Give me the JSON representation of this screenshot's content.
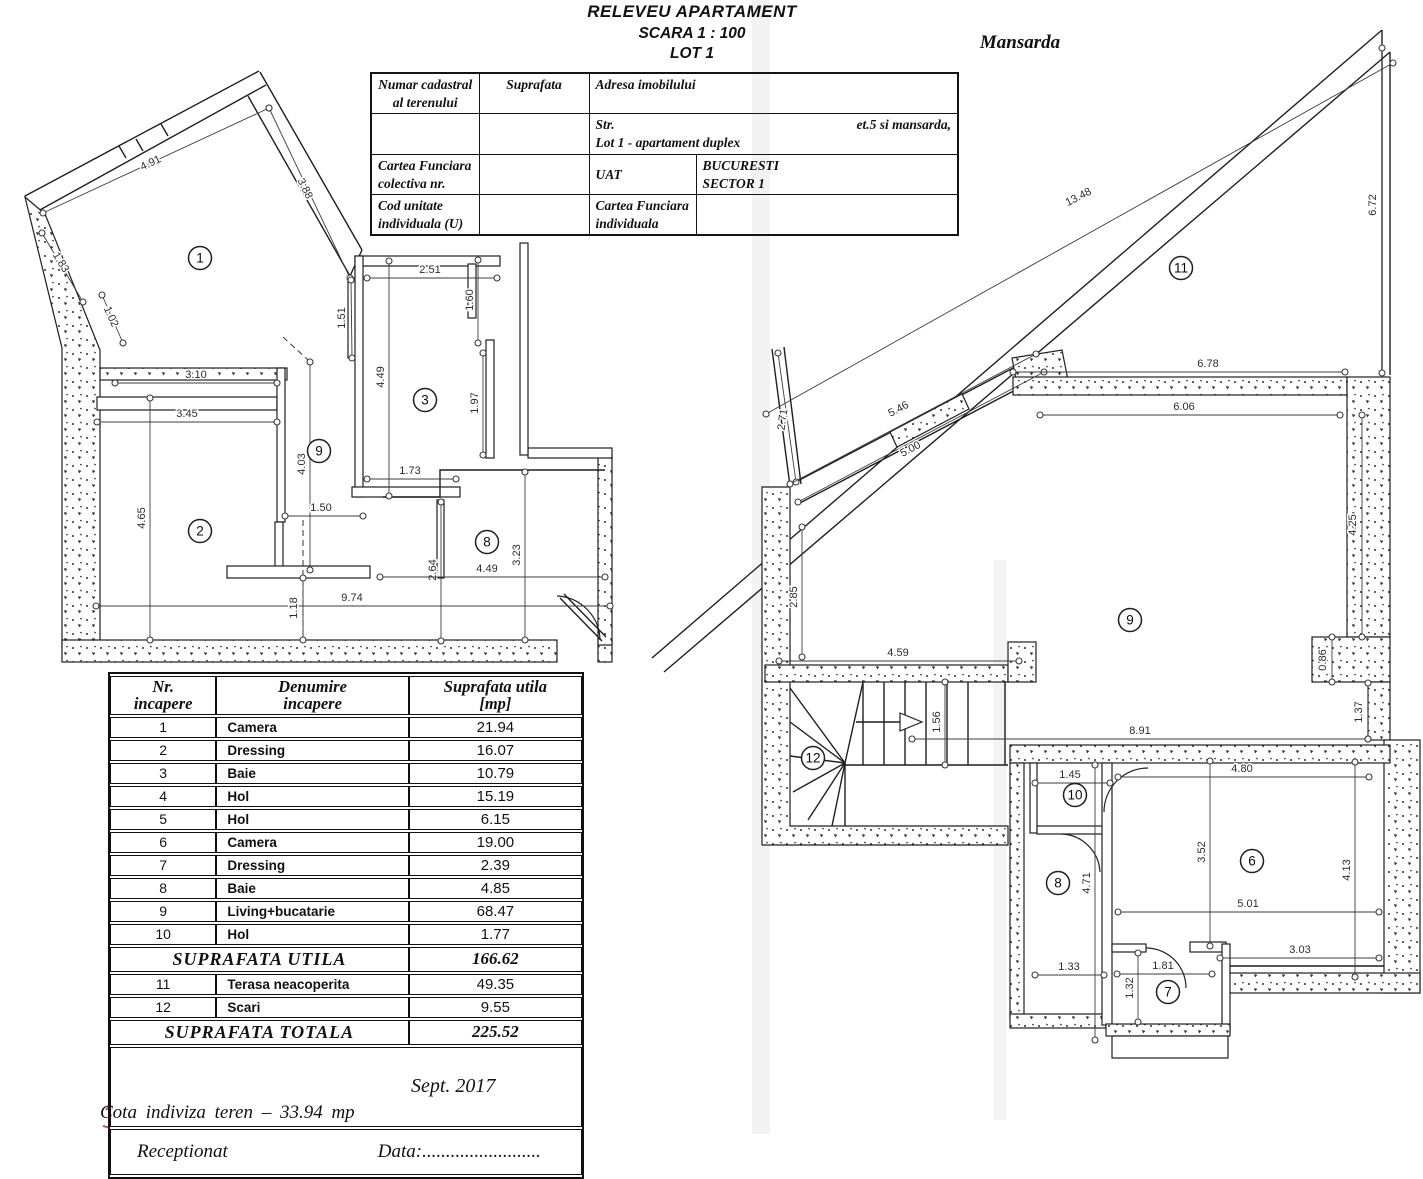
{
  "title": {
    "line1": "RELEVEU APARTAMENT",
    "line2": "SCARA 1 : 100",
    "line3": "LOT 1"
  },
  "plan_labels": {
    "right": "Mansarda"
  },
  "cadastral_table": {
    "r1c1": "Numar cadastral al terenului",
    "r1c2": "Suprafata",
    "r1c3": "Adresa imobilului",
    "r2_str": "Str.",
    "r2_et": "et.5 si mansarda,",
    "r2_lot": "Lot 1 - apartament duplex",
    "r3c1a": "Cartea Funciara",
    "r3c1b": "colectiva nr.",
    "r3c3": "UAT",
    "r3c4a": "BUCURESTI",
    "r3c4b": "SECTOR 1",
    "r4c1a": "Cod unitate",
    "r4c1b": "individuala (U)",
    "r4c3a": "Cartea Funciara",
    "r4c3b": "individuala"
  },
  "room_table": {
    "header": {
      "col1a": "Nr.",
      "col1b": "incapere",
      "col2a": "Denumire",
      "col2b": "incapere",
      "col3a": "Suprafata utila",
      "col3b": "[mp]"
    },
    "rows": [
      {
        "nr": "1",
        "name": "Camera",
        "area": "21.94"
      },
      {
        "nr": "2",
        "name": "Dressing",
        "area": "16.07"
      },
      {
        "nr": "3",
        "name": "Baie",
        "area": "10.79"
      },
      {
        "nr": "4",
        "name": "Hol",
        "area": "15.19"
      },
      {
        "nr": "5",
        "name": "Hol",
        "area": "6.15"
      },
      {
        "nr": "6",
        "name": "Camera",
        "area": "19.00"
      },
      {
        "nr": "7",
        "name": "Dressing",
        "area": "2.39"
      },
      {
        "nr": "8",
        "name": "Baie",
        "area": "4.85"
      },
      {
        "nr": "9",
        "name": "Living+bucatarie",
        "area": "68.47"
      },
      {
        "nr": "10",
        "name": "Hol",
        "area": "1.77"
      }
    ],
    "subtotal_label": "SUPRAFATA  UTILA",
    "subtotal_value": "166.62",
    "rows2": [
      {
        "nr": "11",
        "name": "Terasa neacoperita",
        "area": "49.35"
      },
      {
        "nr": "12",
        "name": "Scari",
        "area": "9.55"
      }
    ],
    "total_label": "SUPRAFATA  TOTALA",
    "total_value": "225.52",
    "date": "Sept.  2017",
    "receptionat": "Receptionat",
    "data_label": "Data:.........................",
    "cota_line": "Cota indiviza teren   –   33.94  mp"
  },
  "floorplan_left": {
    "rooms": [
      {
        "n": "1",
        "x": 200,
        "y": 258
      },
      {
        "n": "2",
        "x": 200,
        "y": 531
      },
      {
        "n": "3",
        "x": 425,
        "y": 400
      },
      {
        "n": "9",
        "x": 319,
        "y": 451
      },
      {
        "n": "8",
        "x": 487,
        "y": 542
      }
    ],
    "dims": [
      {
        "t": "4.91",
        "x1": 43,
        "y1": 213,
        "x2": 269,
        "y2": 108,
        "tx": 152,
        "ty": 166,
        "r": -25
      },
      {
        "t": "3.88",
        "x1": 269,
        "y1": 108,
        "x2": 350,
        "y2": 278,
        "tx": 302,
        "ty": 190,
        "r": 64
      },
      {
        "t": "1.83",
        "x1": 42,
        "y1": 233,
        "x2": 83,
        "y2": 302,
        "tx": 58,
        "ty": 264,
        "r": 59
      },
      {
        "t": "1.02",
        "x1": 102,
        "y1": 295,
        "x2": 123,
        "y2": 343,
        "tx": 108,
        "ty": 318,
        "r": 66
      },
      {
        "t": "3.10",
        "x1": 115,
        "y1": 383,
        "x2": 277,
        "y2": 383,
        "tx": 196,
        "ty": 378,
        "r": 0
      },
      {
        "t": "1.51",
        "x1": 351,
        "y1": 280,
        "x2": 352,
        "y2": 358,
        "tx": 345,
        "ty": 318,
        "r": -90
      },
      {
        "t": "3.45",
        "x1": 97,
        "y1": 422,
        "x2": 277,
        "y2": 422,
        "tx": 187,
        "ty": 417,
        "r": 0
      },
      {
        "t": "4.65",
        "x1": 150,
        "y1": 398,
        "x2": 150,
        "y2": 640,
        "tx": 145,
        "ty": 518,
        "r": -90
      },
      {
        "t": "2.51",
        "x1": 367,
        "y1": 278,
        "x2": 497,
        "y2": 278,
        "tx": 430,
        "ty": 273,
        "r": 0
      },
      {
        "t": "1.60",
        "x1": 478,
        "y1": 260,
        "x2": 478,
        "y2": 343,
        "tx": 473,
        "ty": 300,
        "r": -90
      },
      {
        "t": "4.49",
        "x1": 389,
        "y1": 261,
        "x2": 389,
        "y2": 496,
        "tx": 384,
        "ty": 377,
        "r": -90
      },
      {
        "t": "1.97",
        "x1": 483,
        "y1": 353,
        "x2": 483,
        "y2": 455,
        "tx": 478,
        "ty": 403,
        "r": -90
      },
      {
        "t": "4.03",
        "x1": 310,
        "y1": 362,
        "x2": 310,
        "y2": 570,
        "tx": 305,
        "ty": 464,
        "r": -90
      },
      {
        "t": "1.73",
        "x1": 367,
        "y1": 479,
        "x2": 456,
        "y2": 479,
        "tx": 410,
        "ty": 474,
        "r": 0
      },
      {
        "t": "1.50",
        "x1": 285,
        "y1": 516,
        "x2": 363,
        "y2": 516,
        "tx": 321,
        "ty": 511,
        "r": 0
      },
      {
        "t": "9.74",
        "x1": 96,
        "y1": 606,
        "x2": 610,
        "y2": 606,
        "tx": 352,
        "ty": 601,
        "r": 0
      },
      {
        "t": "1.18",
        "x1": 303,
        "y1": 578,
        "x2": 303,
        "y2": 640,
        "tx": 297,
        "ty": 608,
        "r": -90
      },
      {
        "t": "2.64",
        "x1": 441,
        "y1": 502,
        "x2": 441,
        "y2": 641,
        "tx": 436,
        "ty": 570,
        "r": -90
      },
      {
        "t": "3.23",
        "x1": 525,
        "y1": 472,
        "x2": 525,
        "y2": 640,
        "tx": 520,
        "ty": 555,
        "r": -90
      },
      {
        "t": "4.49",
        "x1": 380,
        "y1": 577,
        "x2": 605,
        "y2": 577,
        "tx": 487,
        "ty": 572,
        "r": 0
      }
    ]
  },
  "floorplan_right": {
    "rooms": [
      {
        "n": "11",
        "x": 1181,
        "y": 268
      },
      {
        "n": "9",
        "x": 1130,
        "y": 620
      },
      {
        "n": "12",
        "x": 813,
        "y": 758
      },
      {
        "n": "10",
        "x": 1075,
        "y": 795
      },
      {
        "n": "8",
        "x": 1058,
        "y": 883
      },
      {
        "n": "6",
        "x": 1252,
        "y": 861
      },
      {
        "n": "7",
        "x": 1168,
        "y": 992
      }
    ],
    "dims": [
      {
        "t": "13.48",
        "x1": 766,
        "y1": 414,
        "x2": 1393,
        "y2": 63,
        "tx": 1080,
        "ty": 200,
        "r": -27
      },
      {
        "t": "6.72",
        "x1": 1382,
        "y1": 48,
        "x2": 1382,
        "y2": 373,
        "tx": 1376,
        "ty": 205,
        "r": -90
      },
      {
        "t": "2.71",
        "x1": 778,
        "y1": 353,
        "x2": 796,
        "y2": 482,
        "tx": 786,
        "ty": 420,
        "r": -82
      },
      {
        "t": "5.46",
        "x1": 790,
        "y1": 484,
        "x2": 1036,
        "y2": 354,
        "tx": 900,
        "ty": 412,
        "r": -28
      },
      {
        "t": "5.00",
        "x1": 798,
        "y1": 502,
        "x2": 1044,
        "y2": 372,
        "tx": 912,
        "ty": 452,
        "r": -28
      },
      {
        "t": "6.78",
        "x1": 1013,
        "y1": 372,
        "x2": 1345,
        "y2": 372,
        "tx": 1208,
        "ty": 367,
        "r": 0
      },
      {
        "t": "6.06",
        "x1": 1040,
        "y1": 415,
        "x2": 1340,
        "y2": 415,
        "tx": 1184,
        "ty": 410,
        "r": 0
      },
      {
        "t": "4.25",
        "x1": 1362,
        "y1": 415,
        "x2": 1362,
        "y2": 637,
        "tx": 1356,
        "ty": 525,
        "r": -90
      },
      {
        "t": "2.85",
        "x1": 802,
        "y1": 527,
        "x2": 802,
        "y2": 657,
        "tx": 797,
        "ty": 597,
        "r": -90
      },
      {
        "t": "4.59",
        "x1": 779,
        "y1": 661,
        "x2": 1019,
        "y2": 661,
        "tx": 898,
        "ty": 656,
        "r": 0
      },
      {
        "t": "1.56",
        "x1": 945,
        "y1": 682,
        "x2": 945,
        "y2": 765,
        "tx": 940,
        "ty": 722,
        "r": -90
      },
      {
        "t": "0.86",
        "x1": 1332,
        "y1": 637,
        "x2": 1332,
        "y2": 682,
        "tx": 1326,
        "ty": 660,
        "r": -90
      },
      {
        "t": "1.37",
        "x1": 1368,
        "y1": 683,
        "x2": 1368,
        "y2": 739,
        "tx": 1362,
        "ty": 712,
        "r": -90
      },
      {
        "t": "8.91",
        "x1": 912,
        "y1": 739,
        "x2": 1368,
        "y2": 739,
        "tx": 1140,
        "ty": 734,
        "r": 0
      },
      {
        "t": "1.45",
        "x1": 1035,
        "y1": 783,
        "x2": 1110,
        "y2": 783,
        "tx": 1070,
        "ty": 778,
        "r": 0
      },
      {
        "t": "4.80",
        "x1": 1118,
        "y1": 777,
        "x2": 1369,
        "y2": 777,
        "tx": 1242,
        "ty": 772,
        "r": 0
      },
      {
        "t": "3.52",
        "x1": 1210,
        "y1": 761,
        "x2": 1210,
        "y2": 946,
        "tx": 1205,
        "ty": 852,
        "r": -90
      },
      {
        "t": "4.13",
        "x1": 1355,
        "y1": 762,
        "x2": 1355,
        "y2": 977,
        "tx": 1350,
        "ty": 870,
        "r": -90
      },
      {
        "t": "5.01",
        "x1": 1118,
        "y1": 912,
        "x2": 1379,
        "y2": 912,
        "tx": 1248,
        "ty": 907,
        "r": 0
      },
      {
        "t": "3.03",
        "x1": 1220,
        "y1": 958,
        "x2": 1379,
        "y2": 958,
        "tx": 1300,
        "ty": 953,
        "r": 0
      },
      {
        "t": "4.71",
        "x1": 1095,
        "y1": 765,
        "x2": 1095,
        "y2": 1040,
        "tx": 1090,
        "ty": 883,
        "r": -90
      },
      {
        "t": "1.33",
        "x1": 1035,
        "y1": 975,
        "x2": 1104,
        "y2": 975,
        "tx": 1069,
        "ty": 970,
        "r": 0
      },
      {
        "t": "1.81",
        "x1": 1117,
        "y1": 974,
        "x2": 1212,
        "y2": 974,
        "tx": 1163,
        "ty": 969,
        "r": 0
      },
      {
        "t": "1.32",
        "x1": 1138,
        "y1": 953,
        "x2": 1138,
        "y2": 1022,
        "tx": 1133,
        "ty": 988,
        "r": -90
      }
    ]
  }
}
